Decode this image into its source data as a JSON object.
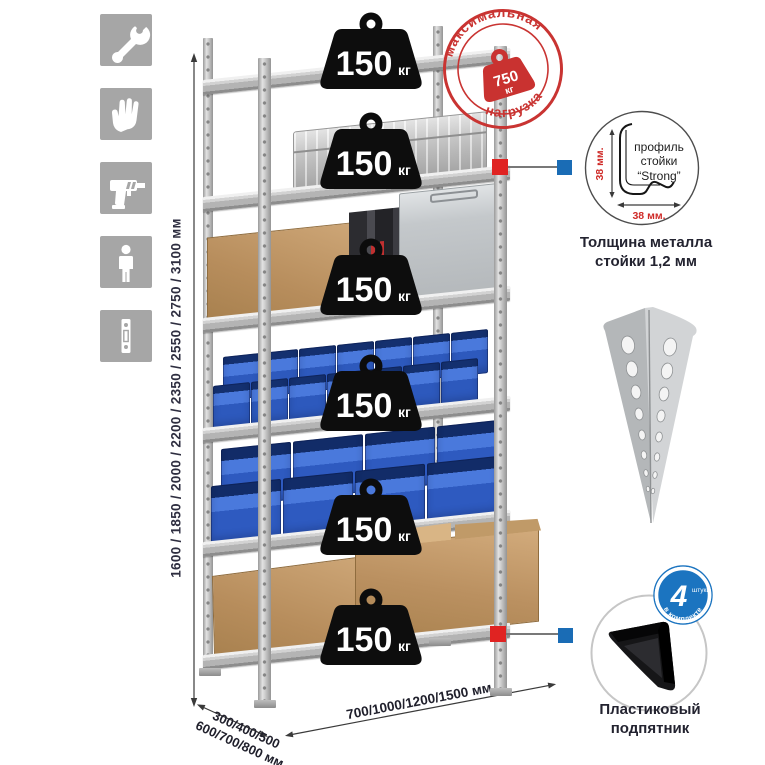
{
  "sidebar": {
    "icons": [
      {
        "name": "wrench"
      },
      {
        "name": "gloves"
      },
      {
        "name": "drill"
      },
      {
        "name": "person"
      },
      {
        "name": "post-profile"
      }
    ]
  },
  "dimensions": {
    "height": "1600 / 1850 / 2000 / 2200 / 2350 / 2550 / 2750 / 3100 мм",
    "depth_line1": "300/400/500",
    "depth_line2": "600/700/800 мм",
    "width": "700/1000/1200/1500 мм"
  },
  "max_load_stamp": {
    "arc_top": "максимальная",
    "arc_bottom": "нагрузка",
    "value": "750",
    "unit": "кг"
  },
  "shelf_weights": [
    {
      "value": "150",
      "unit": "кг"
    },
    {
      "value": "150",
      "unit": "кг"
    },
    {
      "value": "150",
      "unit": "кг"
    },
    {
      "value": "150",
      "unit": "кг"
    },
    {
      "value": "150",
      "unit": "кг"
    },
    {
      "value": "150",
      "unit": "кг"
    }
  ],
  "profile_detail": {
    "label_line1": "профиль",
    "label_line2": "стойки",
    "label_line3": "“Strong”",
    "dim_vertical": "38 мм.",
    "dim_horizontal": "38 мм.",
    "caption": "Толщина металла стойки 1,2 мм"
  },
  "foot_detail": {
    "badge_value": "4",
    "badge_small": "штуки",
    "badge_arc": "в комплекте",
    "caption": "Пластиковый подпятник"
  },
  "colors": {
    "accent_red": "#c93432",
    "accent_blue": "#1a6cb5",
    "bin_blue": "#2d59bd",
    "metal_gray": "#c6c6c6"
  }
}
